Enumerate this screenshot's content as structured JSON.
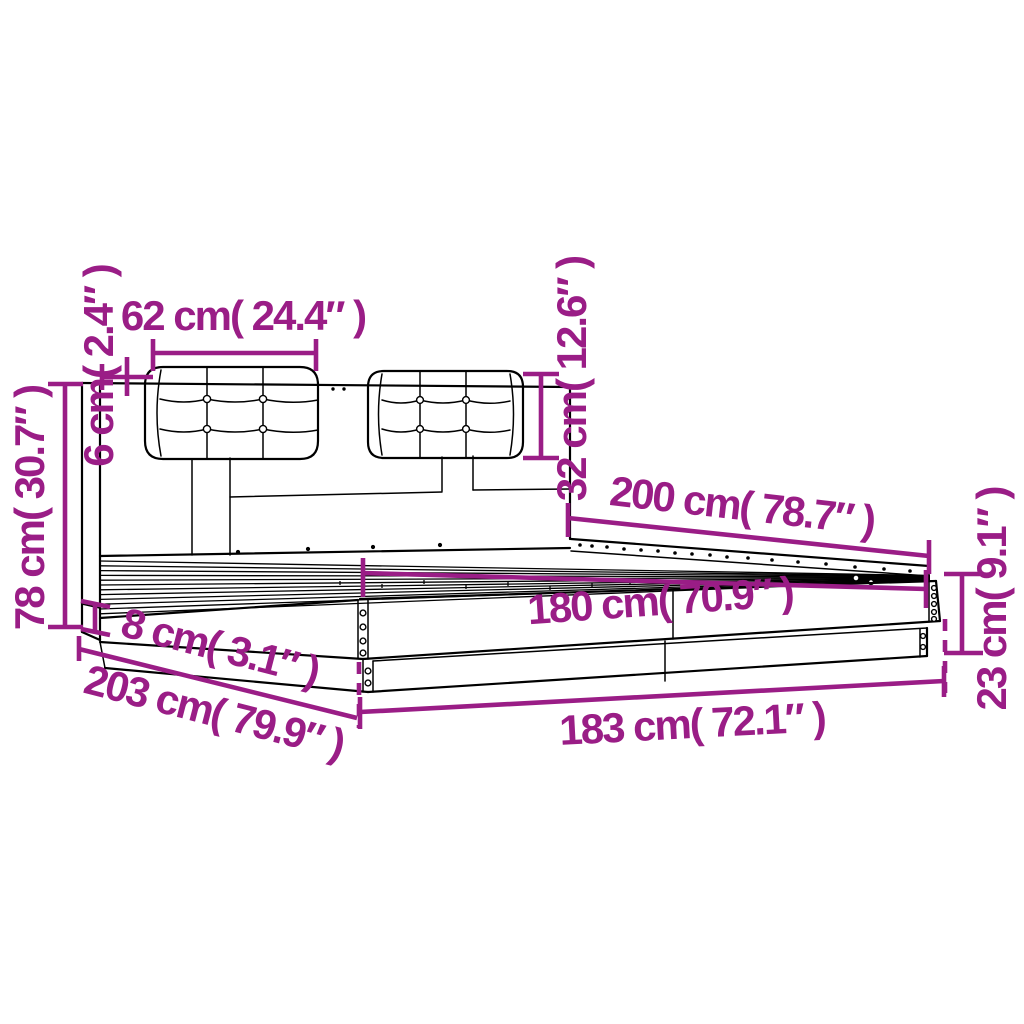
{
  "diagram": {
    "kind": "bed-frame-dimension-diagram",
    "labels": {
      "cushion_width": "62 cm( 24.4″ )",
      "cushion_thickness": "6 cm( 2.4″ )",
      "headboard_height": "78 cm( 30.7″ )",
      "cushion_height": "32 cm( 12.6″ )",
      "bed_length": "200 cm( 78.7″ )",
      "inner_width": "180 cm( 70.9″ )",
      "plinth_height": "8 cm( 3.1″ )",
      "total_length": "203 cm( 79.9″ )",
      "total_width": "183 cm( 72.1″ )",
      "frame_height": "23 cm( 9.1″ )"
    },
    "dimensions_cm": {
      "cushion_width": 62,
      "cushion_thickness": 6,
      "headboard_height": 78,
      "cushion_height": 32,
      "bed_length": 200,
      "inner_width": 180,
      "plinth_height": 8,
      "total_length": 203,
      "total_width": 183,
      "frame_height": 23
    }
  },
  "colors": {
    "dimension": "#9a1d86",
    "line": "#000000",
    "background": "#ffffff"
  }
}
